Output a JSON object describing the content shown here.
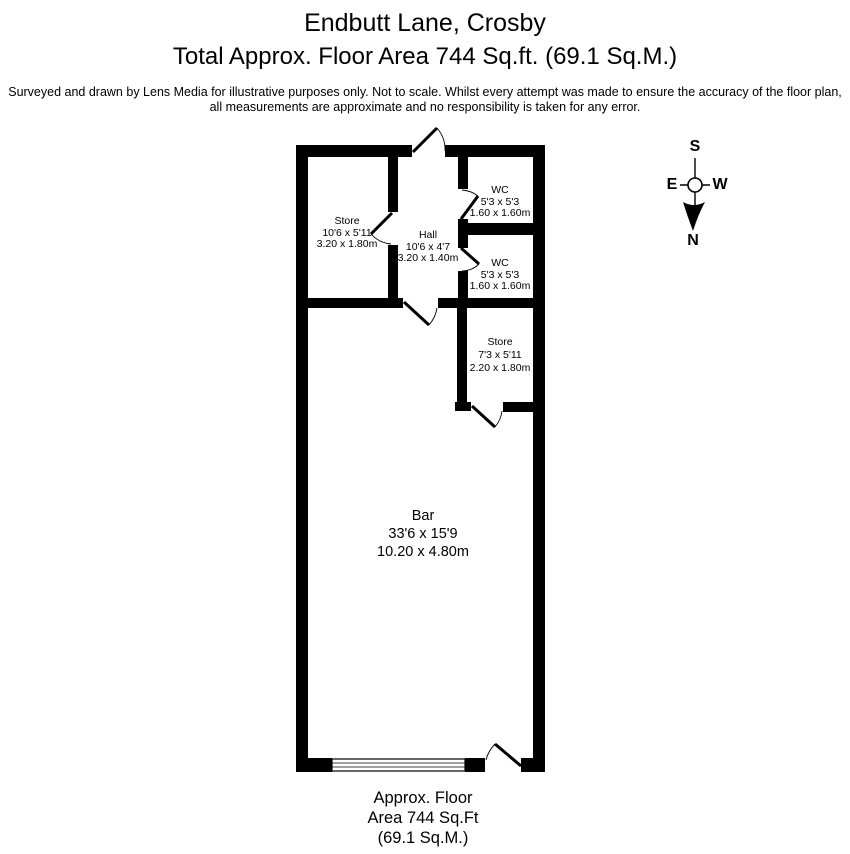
{
  "header": {
    "title": "Endbutt Lane, Crosby",
    "subtitle": "Total Approx. Floor Area 744 Sq.ft. (69.1 Sq.M.)",
    "disclaimer_line1": "Surveyed and drawn by Lens Media for illustrative purposes only. Not to scale. Whilst every attempt was made to ensure the accuracy of the floor plan,",
    "disclaimer_line2": "all measurements are approximate and no responsibility is taken for any error."
  },
  "floorplan": {
    "rooms": [
      {
        "name": "Store",
        "dims_imperial": "10'6 x 5'11",
        "dims_metric": "3.20 x 1.80m"
      },
      {
        "name": "Hall",
        "dims_imperial": "10'6 x 4'7",
        "dims_metric": "3.20 x 1.40m"
      },
      {
        "name": "WC",
        "dims_imperial": "5'3 x 5'3",
        "dims_metric": "1.60 x 1.60m"
      },
      {
        "name": "WC",
        "dims_imperial": "5'3 x 5'3",
        "dims_metric": "1.60 x 1.60m"
      },
      {
        "name": "Store",
        "dims_imperial": "7'3 x 5'11",
        "dims_metric": "2.20 x 1.80m"
      },
      {
        "name": "Bar",
        "dims_imperial": "33'6 x 15'9",
        "dims_metric": "10.20 x 4.80m"
      }
    ]
  },
  "compass": {
    "north": "N",
    "south": "S",
    "east": "E",
    "west": "W"
  },
  "footer": {
    "line1": "Approx. Floor",
    "line2": "Area 744 Sq.Ft",
    "line3": "(69.1 Sq.M.)"
  },
  "colors": {
    "background": "#ffffff",
    "walls": "#000000",
    "text": "#000000"
  }
}
